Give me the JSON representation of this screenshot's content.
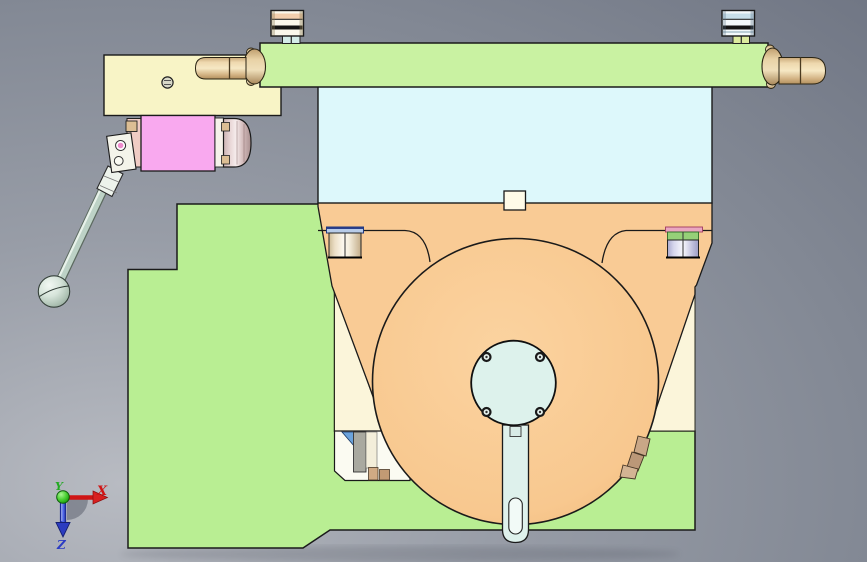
{
  "view": {
    "type": "cad-3d-viewport",
    "projection": "front",
    "background_color": "#9298a3"
  },
  "triad": {
    "x_label": "X",
    "y_label": "Y",
    "z_label": "Z"
  },
  "palette": {
    "outline": "#1a1a1a",
    "background": "#9298a3",
    "base_body_green": "#b9ee93",
    "clamp_bar_green": "#c9f2a2",
    "face_panel_cyan": "#ddf8fb",
    "support_plate_orange": "#f9cb95",
    "flank_cream": "#fbf5da",
    "gearbox_yellow": "#f8f4c6",
    "motor_pink": "#f9a9ef",
    "hub_cyan": "#ddf2ec",
    "strap_cyan": "#def1ec",
    "handle_tan": "#e7cb9c",
    "bolt_rim_blue": "#b8cce8",
    "bolt_rim_green": "#96d078",
    "bolt_rim_pink": "#eaa6c0",
    "latch_blue": "#6ba3dc",
    "latch_gray": "#a9a9a0",
    "hook_tan": "#c9a787",
    "axis_x_red": "#cf1515",
    "axis_y_green": "#22aa22",
    "axis_z_blue": "#2b3cc4"
  },
  "parts": [
    {
      "name": "base-body",
      "color_key": "base_body_green"
    },
    {
      "name": "top-clamp-bar",
      "color_key": "clamp_bar_green"
    },
    {
      "name": "face-panel",
      "color_key": "face_panel_cyan"
    },
    {
      "name": "support-plate",
      "color_key": "support_plate_orange"
    },
    {
      "name": "rotary-disc",
      "color_key": "support_plate_orange"
    },
    {
      "name": "center-hub",
      "color_key": "hub_cyan"
    },
    {
      "name": "pointer-strap",
      "color_key": "strap_cyan"
    },
    {
      "name": "gearbox-block",
      "color_key": "gearbox_yellow"
    },
    {
      "name": "motor-block",
      "color_key": "motor_pink"
    },
    {
      "name": "clamp-lever",
      "color_key": "strap_cyan"
    },
    {
      "name": "left-handle-pin",
      "color_key": "handle_tan"
    },
    {
      "name": "right-handle-pin",
      "color_key": "handle_tan"
    },
    {
      "name": "left-flank",
      "color_key": "flank_cream"
    },
    {
      "name": "right-flank",
      "color_key": "flank_cream"
    }
  ]
}
